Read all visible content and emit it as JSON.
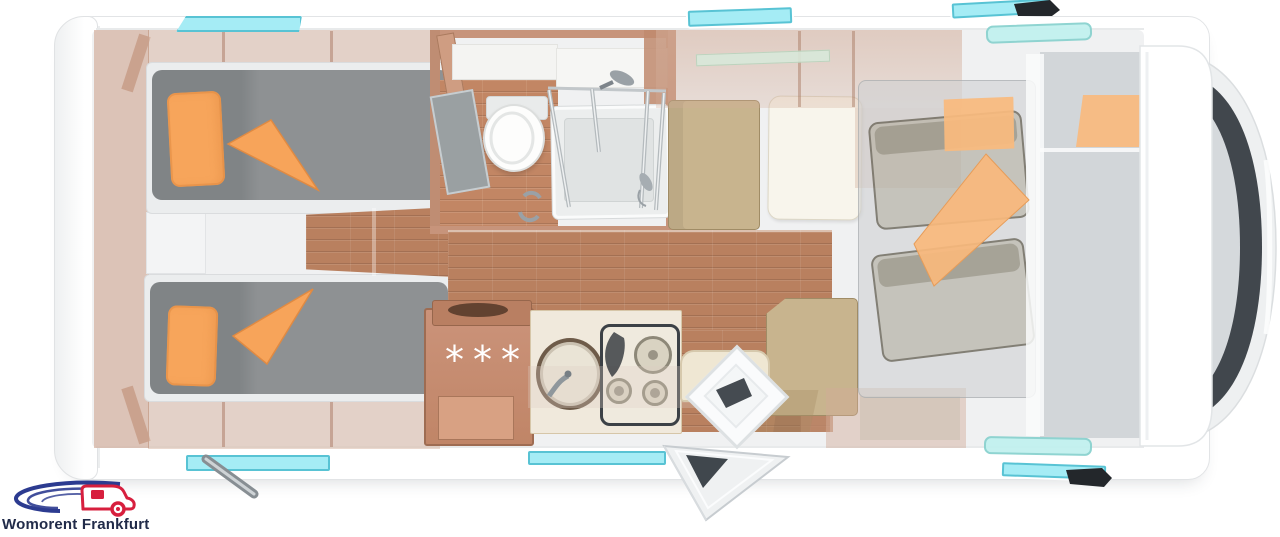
{
  "brand": {
    "name": "Womorent Frankfurt"
  },
  "floorplan": {
    "view": "motorhome top-down floor plan",
    "fridge_symbol": "***"
  },
  "colors": {
    "accent_orange": "#f7a55b",
    "window_cyan": "#a5ecf5",
    "floor_wood": "#b9805f",
    "furniture_wood": "#c9937a",
    "mattress_gray": "#8b8e90",
    "cushion_beige": "#c8b48e",
    "windshield_dark": "#41474d",
    "logo_red": "#d71f3e",
    "logo_blue": "#2c3b90",
    "logo_text": "#212b49"
  }
}
